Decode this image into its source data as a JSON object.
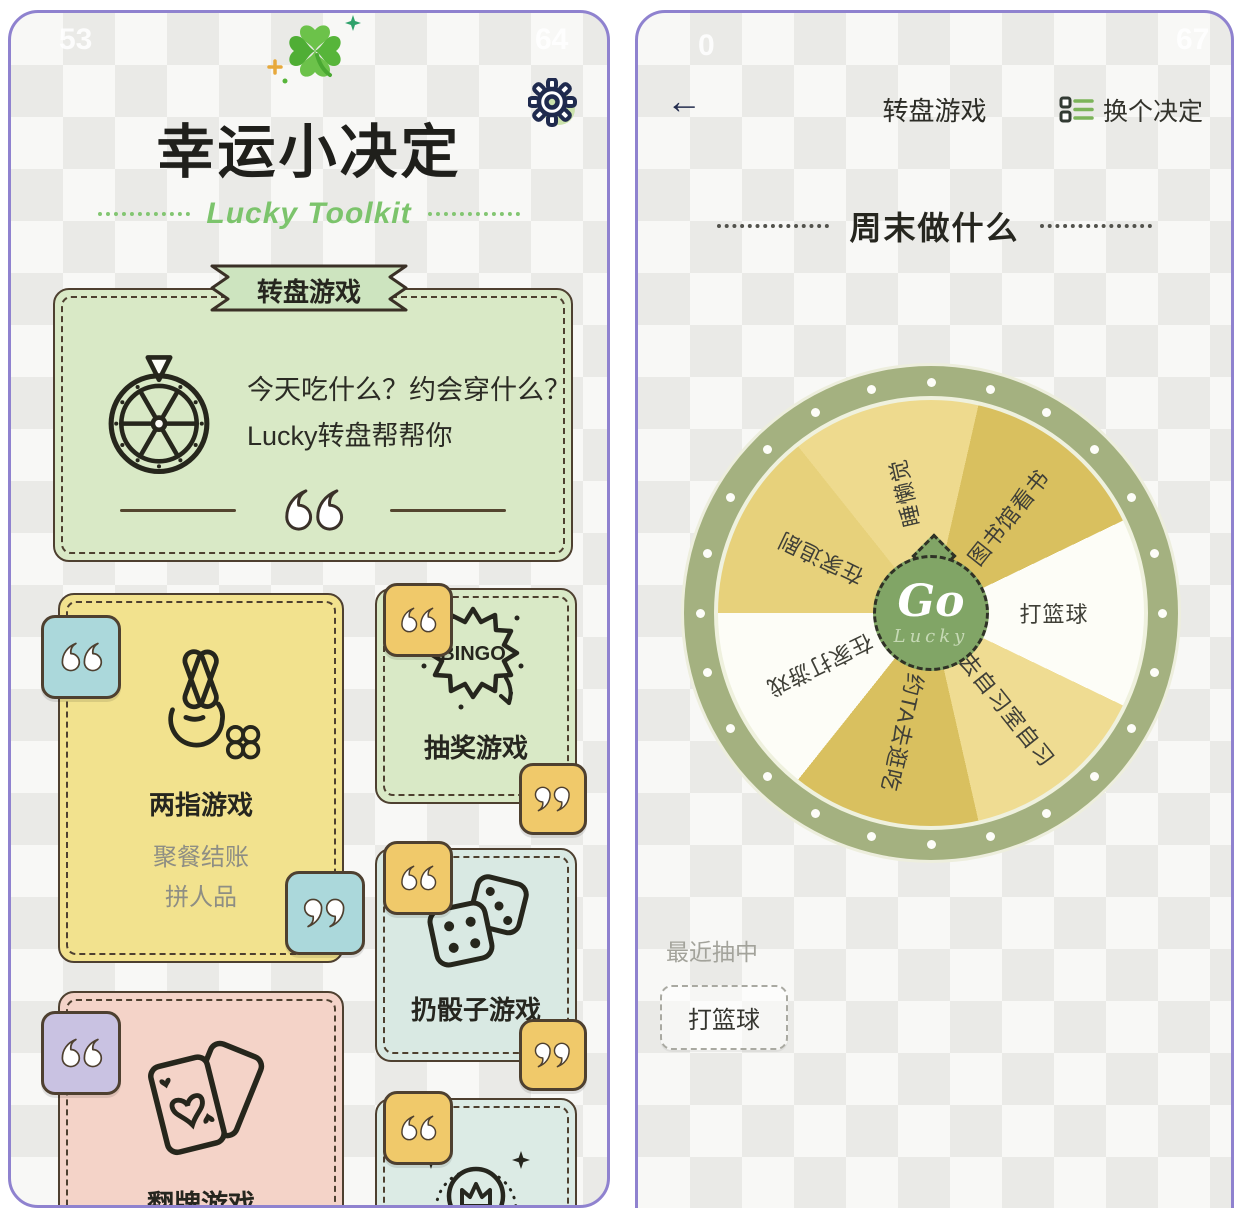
{
  "colors": {
    "frame": "#8f82cf",
    "card_green": "#d9e9c6",
    "card_yellow": "#f2e28e",
    "card_blue": "#d9e9e3",
    "card_pink": "#f4d3c8",
    "card_mint": "#dcebe5",
    "tag_blue": "#abd8db",
    "tag_yellow": "#f0c96a",
    "tag_purple": "#c9c2e2",
    "ribbon_green": "#cde4bf",
    "accent_green": "#7cc46c",
    "wheel_ring": "#a4b180",
    "go_green": "#81a566"
  },
  "watermarks": {
    "left_a": "53",
    "left_b": "64",
    "right_a": "0",
    "right_b": "67"
  },
  "left_screen": {
    "app_title": "幸运小决定",
    "app_subtitle": "Lucky Toolkit",
    "banner": "转盘游戏",
    "wheel_card": {
      "line1": "今天吃什么？约会穿什么？",
      "line2": "Lucky转盘帮帮你"
    },
    "finger_card": {
      "title": "两指游戏",
      "desc1": "聚餐结账",
      "desc2": "拼人品"
    },
    "bingo_card": {
      "title": "抽奖游戏",
      "icon_text": "BINGO"
    },
    "dice_card": {
      "title": "扔骰子游戏"
    },
    "flip_card": {
      "title": "翻牌游戏"
    },
    "winner_card": {
      "icon_text": "WINNER"
    }
  },
  "right_screen": {
    "nav": {
      "back": "←",
      "title": "转盘游戏",
      "action": "换个决定"
    },
    "question": "周末做什么",
    "wheel": {
      "center_top": "Go",
      "center_bottom": "Lucky",
      "label_radius": 123,
      "segments": [
        {
          "label": "打篮球",
          "color": "#fdfdf7"
        },
        {
          "label": "去自习室自习",
          "color": "#efdc92"
        },
        {
          "label": "约TA去逛吃",
          "color": "#d9c05f"
        },
        {
          "label": "在家打游戏",
          "color": "#fdfdf7"
        },
        {
          "label": "在家追剧",
          "color": "#e7d17b"
        },
        {
          "label": "睡懒觉",
          "color": "#eeda8e"
        },
        {
          "label": "图书馆看书",
          "color": "#d9c05f"
        }
      ]
    },
    "recent": {
      "label": "最近抽中",
      "value": "打篮球"
    }
  }
}
